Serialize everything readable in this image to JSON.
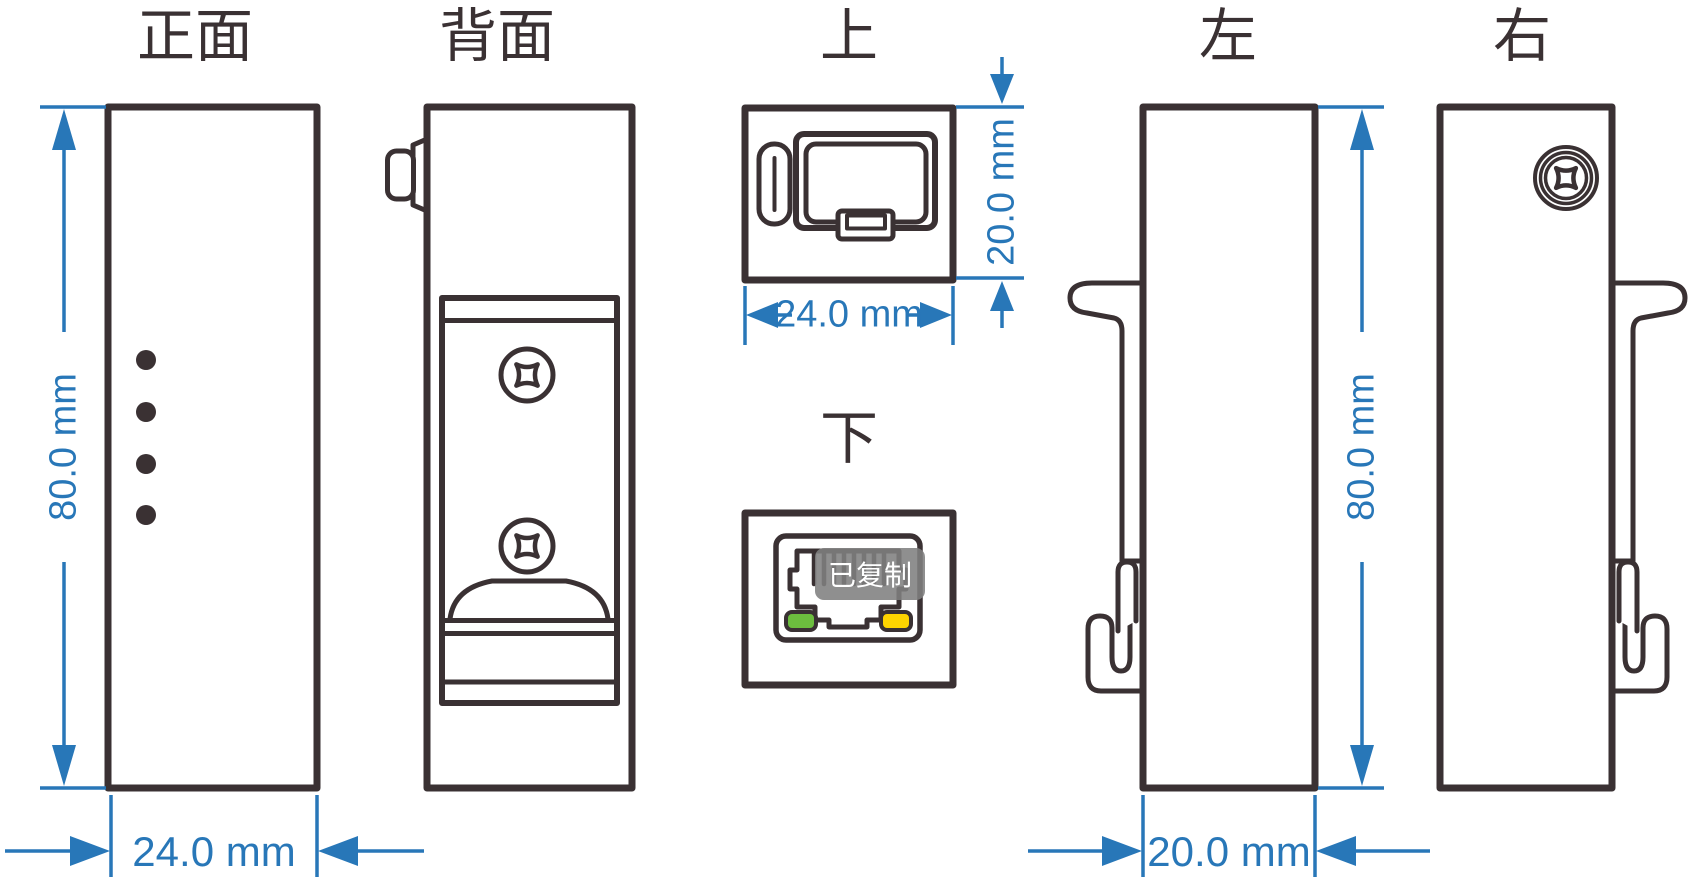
{
  "colors": {
    "line": "#3a3133",
    "dimension": "#2877b8",
    "led_green": "#6cbe3e",
    "led_yellow": "#ffd400",
    "tooltip_bg": "#808080",
    "tooltip_text": "#ffffff"
  },
  "views": {
    "front": {
      "label": "正面",
      "height_dim": "80.0 mm",
      "width_dim": "24.0 mm"
    },
    "back": {
      "label": "背面"
    },
    "top": {
      "label": "上",
      "width_dim": "24.0 mm",
      "depth_dim": "20.0 mm"
    },
    "bottom": {
      "label": "下"
    },
    "left": {
      "label": "左",
      "height_dim": "80.0 mm",
      "width_dim": "20.0 mm"
    },
    "right": {
      "label": "右"
    }
  },
  "tooltip": {
    "text": "已复制"
  }
}
